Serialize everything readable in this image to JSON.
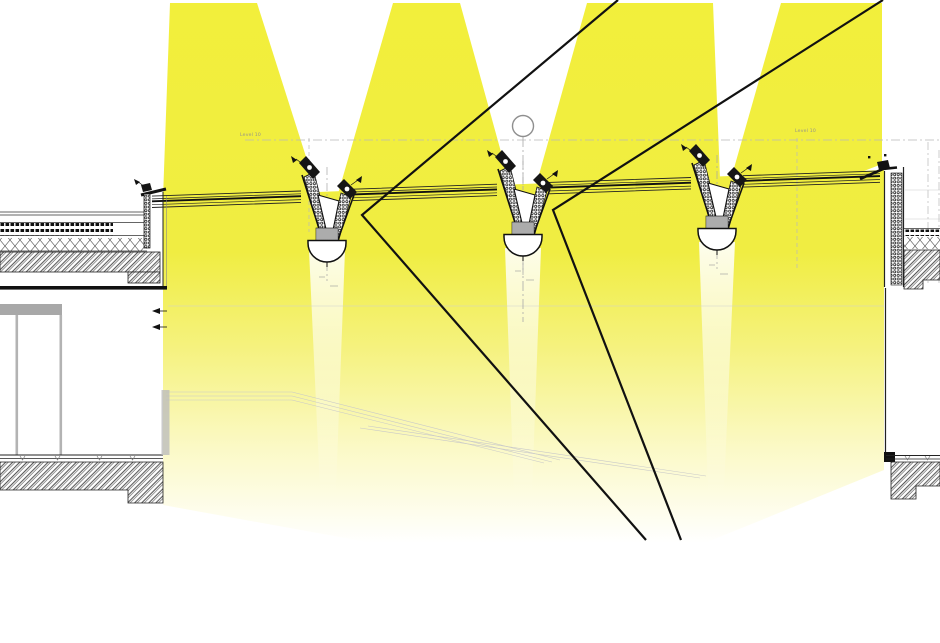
{
  "diagram": {
    "labels": {
      "level_left": "Level 10",
      "level_right": "Level 10"
    },
    "colors": {
      "beam_yellow": "#F2EF3B",
      "beam_mid": "#F0ED42",
      "beam_fade_1": "#F5F27E",
      "beam_fade_2": "#FBF9C6",
      "beam_end": "#FFFFFF",
      "ray_black": "#111111",
      "line_dark": "#1c1c1c",
      "line_mid": "#444444",
      "reference_gray": "#b9b9b9",
      "wall_gray": "#a8a8a8"
    },
    "symbols": {
      "grid_bubble": "circle-marker",
      "section_centerline": "dash-dot",
      "fixing_arrows": "small-black-triangles",
      "screed_marks": "small-v-ticks"
    },
    "beams": {
      "count": 4
    },
    "reflected_rays": {
      "count": 2
    }
  }
}
